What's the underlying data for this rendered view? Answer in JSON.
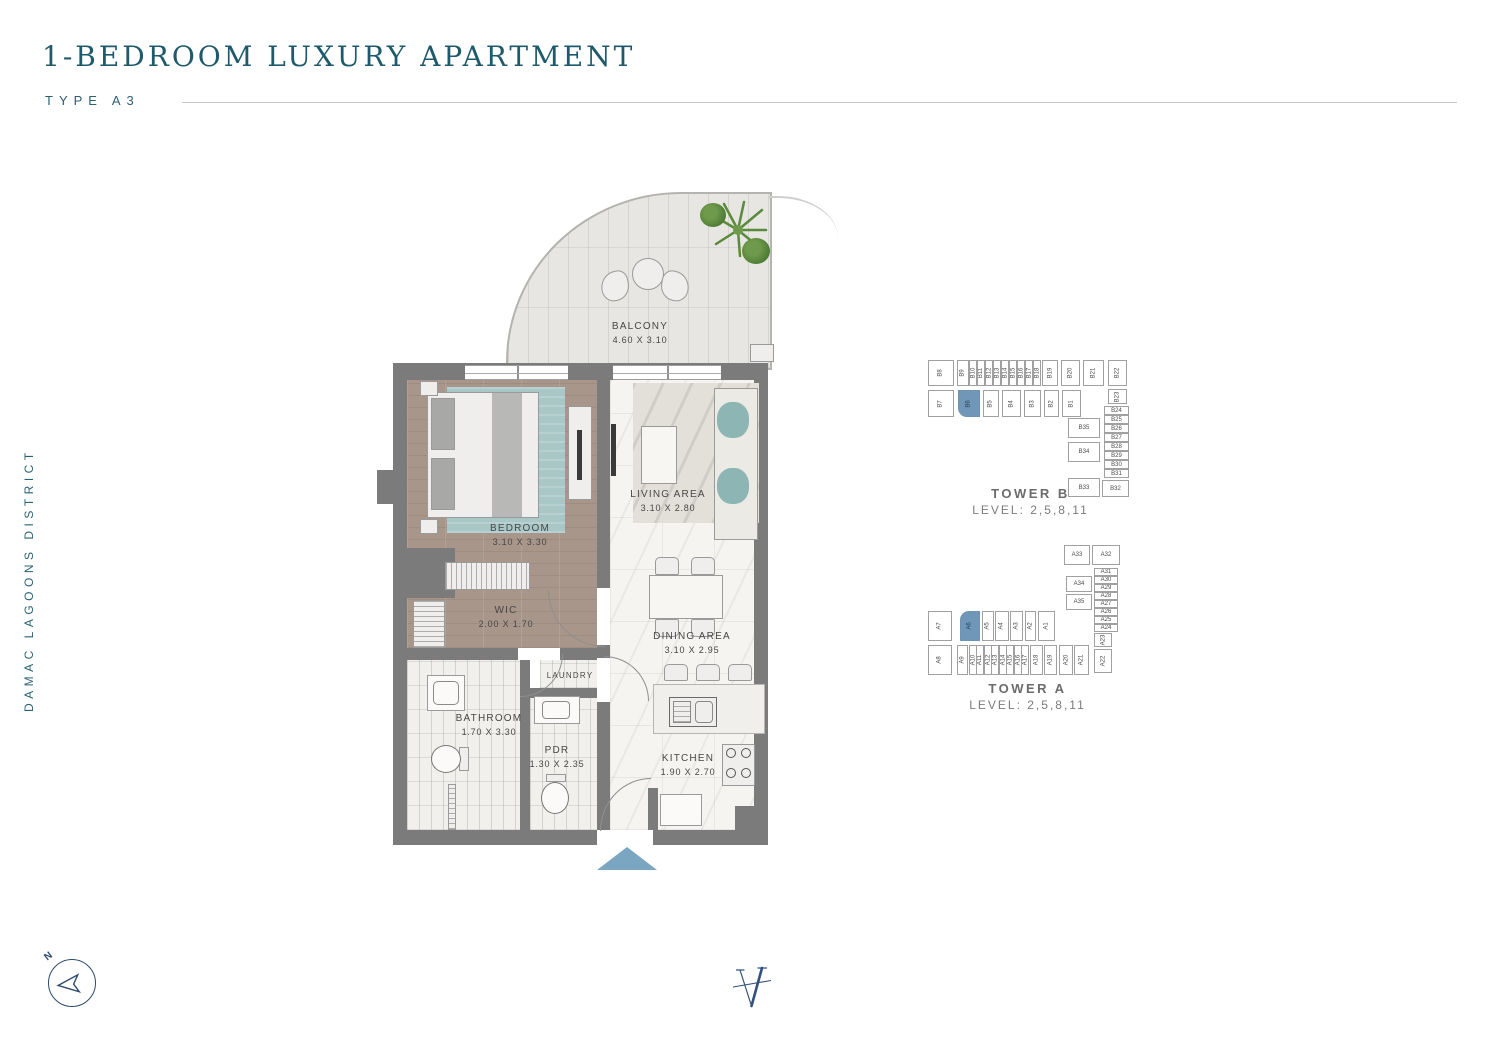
{
  "header": {
    "title": "1-BEDROOM LUXURY APARTMENT",
    "subtitle": "TYPE A3"
  },
  "side_label": "DAMAC LAGOONS DISTRICT",
  "colors": {
    "accent_teal": "#1E5A6C",
    "highlight_blue": "#7097B7",
    "entry_arrow_blue": "#7BA6C2",
    "wall_gray": "#7B7B7B",
    "logo_navy": "#31507D"
  },
  "floorplan": {
    "rooms": [
      {
        "id": "balcony",
        "label": "BALCONY",
        "dims": "4.60 X 3.10"
      },
      {
        "id": "bedroom",
        "label": "BEDROOM",
        "dims": "3.10 X 3.30"
      },
      {
        "id": "living",
        "label": "LIVING AREA",
        "dims": "3.10 X 2.80"
      },
      {
        "id": "wic",
        "label": "WIC",
        "dims": "2.00 X 1.70"
      },
      {
        "id": "dining",
        "label": "DINING AREA",
        "dims": "3.10 X 2.95"
      },
      {
        "id": "laundry",
        "label": "LAUNDRY",
        "dims": ""
      },
      {
        "id": "bathroom",
        "label": "BATHROOM",
        "dims": "1.70 X 3.30"
      },
      {
        "id": "pdr",
        "label": "PDR",
        "dims": "1.30 X 2.35"
      },
      {
        "id": "kitchen",
        "label": "KITCHEN",
        "dims": "1.90 X 2.70"
      }
    ]
  },
  "towers": [
    {
      "id": "tower-b",
      "name": "TOWER B",
      "level": "LEVEL: 2,5,8,11",
      "highlighted": "B6",
      "units": [
        "B1",
        "B2",
        "B3",
        "B4",
        "B5",
        "B6",
        "B7",
        "B8",
        "B9",
        "B10",
        "B11",
        "B12",
        "B13",
        "B14",
        "B15",
        "B16",
        "B17",
        "B18",
        "B19",
        "B20",
        "B21",
        "B22",
        "B23",
        "B24",
        "B25",
        "B26",
        "B27",
        "B28",
        "B29",
        "B30",
        "B31",
        "B32",
        "B33",
        "B34",
        "B35"
      ]
    },
    {
      "id": "tower-a",
      "name": "TOWER A",
      "level": "LEVEL: 2,5,8,11",
      "highlighted": "A6",
      "units": [
        "A1",
        "A2",
        "A3",
        "A4",
        "A5",
        "A6",
        "A7",
        "A8",
        "A9",
        "A10",
        "A11",
        "A12",
        "A13",
        "A14",
        "A15",
        "A16",
        "A17",
        "A18",
        "A19",
        "A20",
        "A21",
        "A22",
        "A23",
        "A24",
        "A25",
        "A26",
        "A27",
        "A28",
        "A29",
        "A30",
        "A31",
        "A32",
        "A33",
        "A34",
        "A35"
      ]
    }
  ],
  "compass": {
    "north_label": "N"
  }
}
